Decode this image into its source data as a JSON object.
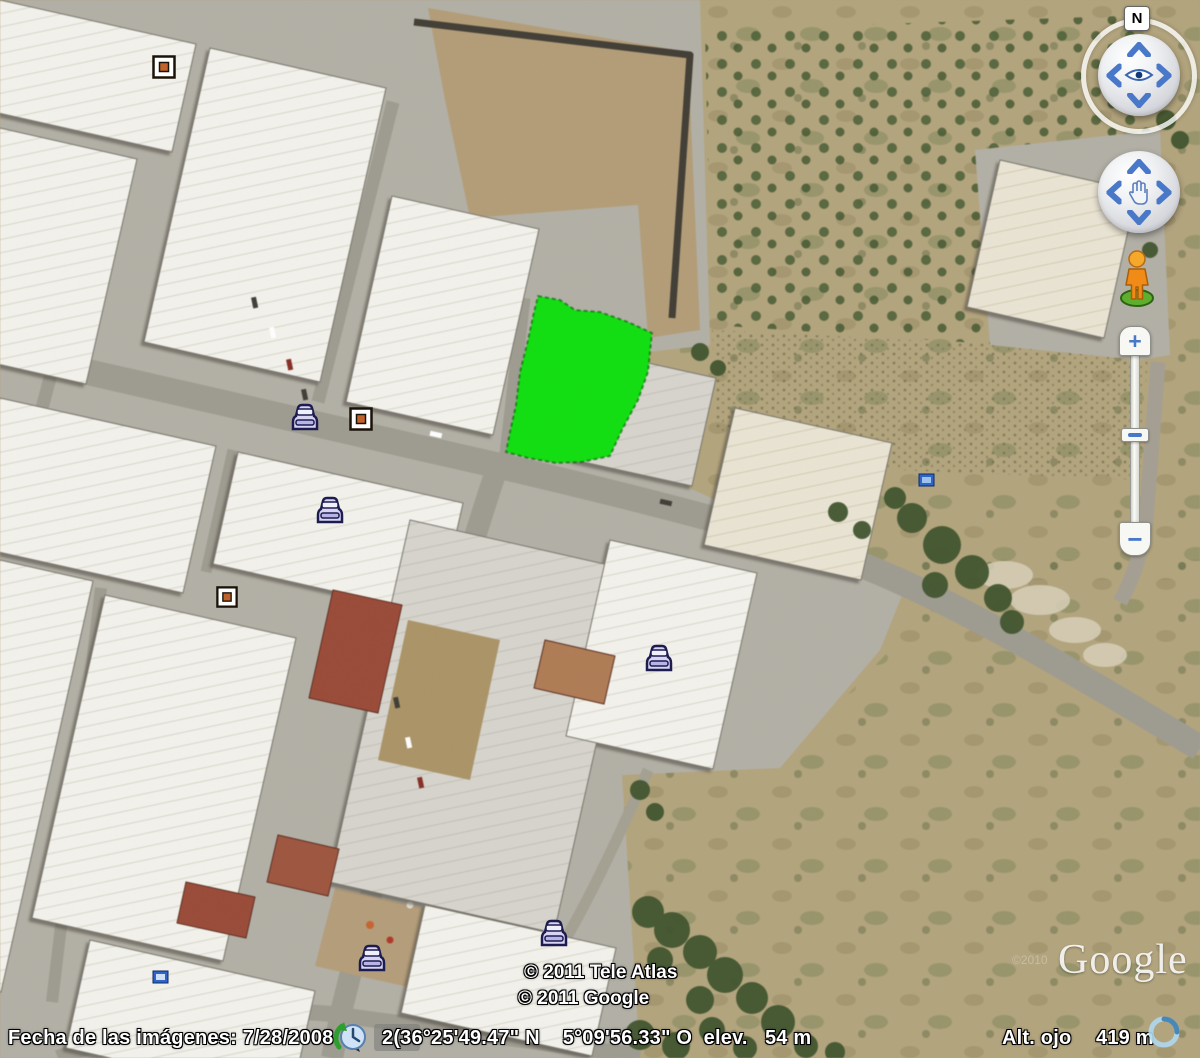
{
  "status_bar": {
    "imagery_date_label": "Fecha de las imágenes:",
    "imagery_date_value": "7/28/2008",
    "coordinates": "2(36°25'49.47\" N    5°09'56.33\" O",
    "elevation_label": "elev.",
    "elevation_value": "54 m",
    "eye_alt_label": "Alt. ojo",
    "eye_alt_value": "419 m"
  },
  "attribution": {
    "line1": "© 2011 Tele Atlas",
    "line2": "© 2011 Google",
    "logo_text": "Google",
    "faint_watermark": "©2010"
  },
  "navigation": {
    "north_label": "N",
    "zoom_in_label": "+",
    "zoom_out_label": "−"
  },
  "overlay": {
    "parcel_color": "#04e204"
  },
  "icons": {
    "historical-imagery-clock-icon": "clock with green arrow",
    "car-poi-icon": "car front view, lavender with navy outline",
    "square-poi-icon": "white square with orange center",
    "sign-poi-icon": "small blue sign",
    "pegman-icon": "orange street view figure on green base",
    "look-joystick": "eye with 4 arrows",
    "move-joystick": "hand with 4 arrows",
    "streaming-icon": "blue progress ring"
  }
}
